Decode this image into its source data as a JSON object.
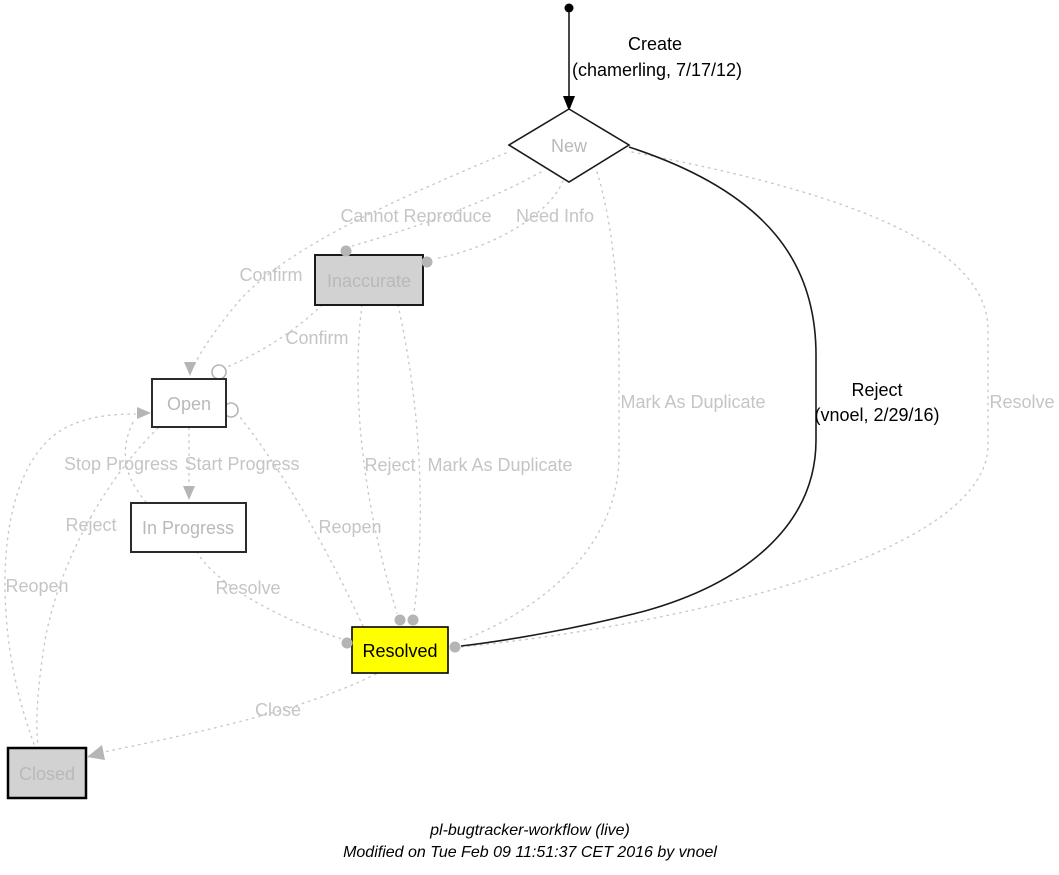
{
  "diagram": {
    "caption": {
      "title": "pl-bugtracker-workflow (live)",
      "modified": "Modified on Tue Feb 09 11:51:37 CET 2016 by vnoel"
    },
    "colors": {
      "current_state_fill": "#ffff00",
      "disabled_state_fill": "#d2d2d2",
      "active_edge": "#000000",
      "inactive_edge": "#c9c9c9",
      "inactive_text": "#c5c5c5"
    },
    "nodes": [
      {
        "id": "new",
        "label": "New",
        "shape": "diamond"
      },
      {
        "id": "inaccurate",
        "label": "Inaccurate",
        "shape": "box"
      },
      {
        "id": "open",
        "label": "Open",
        "shape": "box"
      },
      {
        "id": "in-progress",
        "label": "In Progress",
        "shape": "box"
      },
      {
        "id": "resolved",
        "label": "Resolved",
        "shape": "box"
      },
      {
        "id": "closed",
        "label": "Closed",
        "shape": "box"
      }
    ],
    "edges": [
      {
        "id": "create",
        "label": "Create",
        "attribution": "(chamerling, 7/17/12)",
        "from": "start",
        "to": "new",
        "state": "active"
      },
      {
        "id": "reject-new-resolved",
        "label": "Reject",
        "attribution": "(vnoel, 2/29/16)",
        "from": "new",
        "to": "resolved",
        "state": "active"
      },
      {
        "id": "cannot-reproduce",
        "label": "Cannot Reproduce",
        "from": "new",
        "to": "inaccurate",
        "state": "inactive"
      },
      {
        "id": "need-info",
        "label": "Need Info",
        "from": "new",
        "to": "inaccurate",
        "state": "inactive"
      },
      {
        "id": "confirm-new",
        "label": "Confirm",
        "from": "new",
        "to": "open",
        "state": "inactive"
      },
      {
        "id": "confirm-inaccurate",
        "label": "Confirm",
        "from": "inaccurate",
        "to": "open",
        "state": "inactive"
      },
      {
        "id": "reject-inaccurate",
        "label": "Reject",
        "from": "inaccurate",
        "to": "resolved",
        "state": "inactive"
      },
      {
        "id": "mark-as-duplicate-inaccurate",
        "label": "Mark As Duplicate",
        "from": "inaccurate",
        "to": "resolved",
        "state": "inactive"
      },
      {
        "id": "mark-as-duplicate-new",
        "label": "Mark As Duplicate",
        "from": "new",
        "to": "resolved",
        "state": "inactive"
      },
      {
        "id": "resolve-new",
        "label": "Resolve",
        "from": "new",
        "to": "resolved",
        "state": "inactive"
      },
      {
        "id": "start-progress",
        "label": "Start Progress",
        "from": "open",
        "to": "in-progress",
        "state": "inactive"
      },
      {
        "id": "stop-progress",
        "label": "Stop Progress",
        "from": "in-progress",
        "to": "open",
        "state": "inactive"
      },
      {
        "id": "reject-open",
        "label": "Reject",
        "from": "open",
        "to": "closed",
        "state": "inactive"
      },
      {
        "id": "resolve-in-progress",
        "label": "Resolve",
        "from": "in-progress",
        "to": "resolved",
        "state": "inactive"
      },
      {
        "id": "reopen-resolved",
        "label": "Reopen",
        "from": "resolved",
        "to": "open",
        "state": "inactive"
      },
      {
        "id": "close",
        "label": "Close",
        "from": "resolved",
        "to": "closed",
        "state": "inactive"
      },
      {
        "id": "reopen-closed",
        "label": "Reopen",
        "from": "closed",
        "to": "open",
        "state": "inactive"
      }
    ]
  }
}
